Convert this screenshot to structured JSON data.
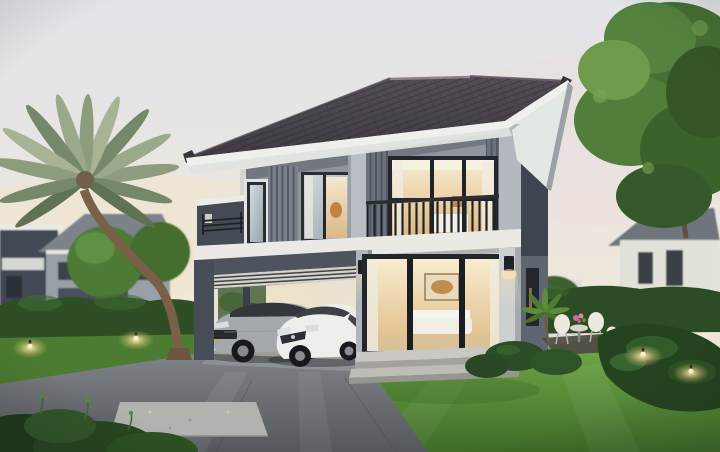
{
  "scene": {
    "setting": "dusk architectural rendering, two-story modern house with carport, two parked cars, lawns and garden",
    "objects": [
      "sky",
      "palm-tree",
      "neighbor-houses-left",
      "neighbor-house-right",
      "big-tree-right",
      "hedges",
      "two-story-house",
      "hip-roof",
      "balcony",
      "carport",
      "suv-car",
      "hatchback-car",
      "sliding-glass-doors",
      "wall-sconces",
      "garden-furniture",
      "garden-lights",
      "lawn",
      "driveway",
      "stone-paver",
      "foreground-bush"
    ]
  },
  "palette": {
    "sky_top": "#e2e4e9",
    "sky_mid": "#eae6e1",
    "sky_horizon": "#f1e8d7",
    "sky_bottom": "#efe5cf",
    "roof_light": "#58515a",
    "roof_dark": "#403b42",
    "fascia": "#eff0ec",
    "soffit": "#e2e8e3",
    "wall_upper": "#8f959d",
    "wall_pillar": "#b9bec5",
    "wall_dark": "#454b56",
    "band": "#eae9e5",
    "glass_cool_1": "#d3dbdf",
    "glass_cool_2": "#98a2aa",
    "glass_warm_1": "#f7ecd0",
    "glass_warm_2": "#e0b983",
    "railing": "#1f2328",
    "carport_frame": "#4e545e",
    "carport_interior": "#e9e2d4",
    "suv_body": "#a4a9ad",
    "hatchback_body": "#edefed",
    "steps": "#c9c8c3",
    "lawn_light": "#74ad4a",
    "lawn_dark": "#3e6b27",
    "left_lawn": "#4c7c31",
    "hedge": "#2e4e26",
    "tree_mid": "#4e7a34",
    "tree_light": "#6f9c4c",
    "palm_frond": "#9aa98c",
    "palm_trunk": "#7a6047",
    "drive_light": "#808488",
    "drive_dark": "#54575b",
    "paver": "#b2b3ae",
    "glow": "#ffedb8",
    "bg_house_wall": "#99a1a8",
    "bg_house_dark": "#434a54",
    "bg_house_white": "#e2e1da"
  }
}
